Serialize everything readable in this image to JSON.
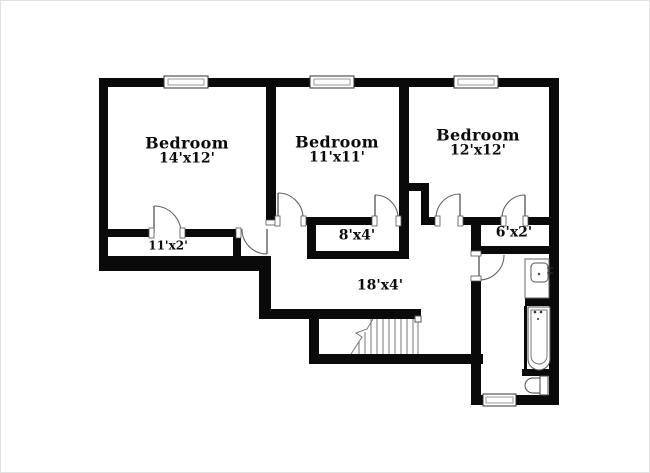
{
  "floorplan": {
    "rooms": {
      "bedroom1": {
        "name": "Bedroom",
        "dims": "14'x12'"
      },
      "bedroom2": {
        "name": "Bedroom",
        "dims": "11'x11'"
      },
      "bedroom3": {
        "name": "Bedroom",
        "dims": "12'x12'"
      },
      "closet1": {
        "dims": "11'x2'"
      },
      "closet2": {
        "dims": "8'x4'"
      },
      "closet3": {
        "dims": "6'x2'"
      },
      "hallway": {
        "dims": "18'x4'"
      }
    },
    "fixtures": [
      "staircase",
      "bathtub",
      "sink",
      "toilet"
    ],
    "window_count": 4,
    "colors": {
      "wall": "#0a0a0a",
      "background": "#ffffff",
      "fixture_stroke": "#555555",
      "door_stroke": "#666666"
    }
  }
}
